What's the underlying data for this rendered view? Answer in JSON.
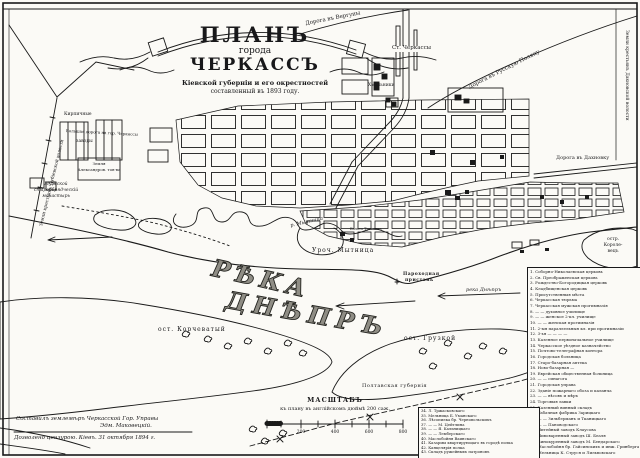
{
  "colors": {
    "ink": "#1a1a1a",
    "paper": "#fbfaf6"
  },
  "title": {
    "line1": "ПЛАНЪ",
    "line2": "города",
    "line3": "ЧЕРКАССЪ",
    "sub1": "Кіевской губерніи и его окрестностей",
    "sub2": "составленный въ 1893 году."
  },
  "labels": {
    "road_verguny": "Дорога въ Вергуны",
    "st_cherkassy": "Ст. Черкассы",
    "road_russ_polyana": "Дорога въ Русскую Поляну",
    "land_dahnovka": "Земли крестьянъ Дахновской волости",
    "road_dahnovka": "Дорога въ Дахновку",
    "hmelniki": "Хмѣльники",
    "land_dubievka": "Земли крестьянъ Дубіевской волости",
    "kirpichnye": "Кирпичные",
    "zavody": "заводы",
    "zemlya_alex1": "Земля",
    "zemlya_alex2": "Александров. тов-ва",
    "mon1": "Мужской",
    "mon2": "старообрядческій",
    "mon3": "монастырь",
    "bolshaya_doroga": "Большая дорога на гор. Черкассы",
    "r_mytnitsa": "р. Мытница",
    "uroch": "Уроч. Мытница",
    "boloto": "Болото Тросянка",
    "pristan1": "Пароходная",
    "pristan2": "пристань",
    "reka_small": "река Днѣпръ",
    "reka_big1": "РѢКА",
    "reka_big2": "ДНѢПРЪ",
    "korchevaty": "ост. Корчеватый",
    "gruzkoy": "ост. Грузкой",
    "korol1": "остр.",
    "korol2": "Короле-",
    "korol3": "вецъ",
    "poltava": "Полтавская губернія"
  },
  "scale": {
    "title": "МАСШТАБЪ",
    "subtitle": "къ плану въ англійскомъ дюймѣ 200 саж.",
    "ticks": [
      "200",
      "400",
      "600",
      "800"
    ]
  },
  "credits": {
    "line1": "Составилъ землемѣръ Черкасской Гор. Управы",
    "line2": "Эдм. Маковецкій.",
    "line3": "Дозволено цензурою. Кіевъ. 31 октября 1894 г."
  },
  "legend": {
    "items": [
      "1. Соборно-Николаевская церковь",
      "2. Св. Преображенская церковь",
      "3. Рождество-Богородицкая церковь",
      "4. Кладбищенская церковь",
      "5. Присутственныя мѣста",
      "6. Черкасская тюрьма",
      "7. Черкасская мужская прогимназія",
      "8. — — духовное училище",
      "9. — — женское 2-кл. училище",
      "10. — — женская прогимназія",
      "11. 2-ыя параллельныя кл. при прогимназіи",
      "12. 3-ья — — — —",
      "13. Казенное первоначальное училище",
      "14. Черкасское уѣздное казначейство",
      "15. Почтово-телеграфная контора",
      "16. Городская больница",
      "17. Старо-базарная аптека",
      "18. Ново-базарная —",
      "19. Еврейская общественная больница",
      "20. — — синагога",
      "21. Городская управа",
      "22. Зданіе пожарнаго обоза и каланча",
      "23. — — вѣсовъ и мѣръ",
      "24. Торговыя лавки",
      "25. Казенный винный складъ",
      "26. Табачная фабрика Зарицкаго",
      "27. — — Зильберманъ и Тканицкаго",
      "28. — — Пановодскаго",
      "29. Литейный заводъ Клаусова",
      "30. Пивоваренный заводъ Ш. Беаля",
      "31. Винокуренный заводъ М. Бендарскаго",
      "32. Маслобойня бр. Гайсинскихъ и инж. Гринберга",
      "33. Мельница К. Струся и Лильвовскаго"
    ]
  },
  "legend2": {
    "items": [
      "34. Л. Тржасковскаго",
      "35. Мельница Б. Уманскаго",
      "36. Лѣсопилка бр. Черновольскихъ",
      "37. — — М. Цейтлина",
      "38. — — Я. Кальницкаго",
      "39. — — Лемберскаго",
      "40. Маслобойня Ваинскаго",
      "41. Казармы квартирующаго въ городѣ полка",
      "42. Канцелярія полка",
      "43. Складъ ружейныхъ патроновъ"
    ]
  }
}
